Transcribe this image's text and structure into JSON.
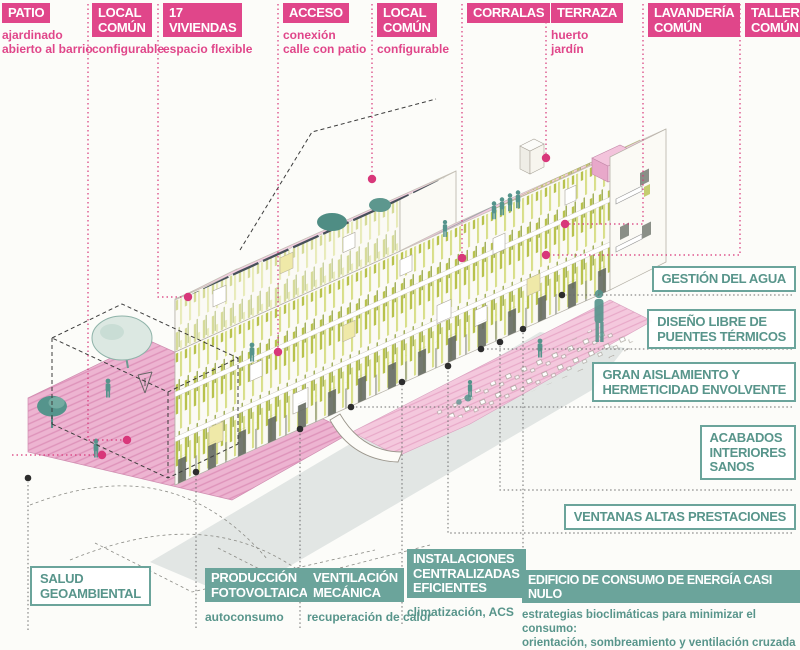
{
  "title": "Diagrama axonométrico de edificio de viviendas con estrategias sostenibles",
  "palette": {
    "paper": "#fcfcf9",
    "pink": "#e0468a",
    "pinkDot": "#d8377a",
    "teal": "#6ba49b",
    "tealText": "#58958b",
    "roof": "#f3cde0",
    "patioHatchBg": "#edb4d1",
    "patioHatchLine": "#de93ba",
    "veg1": "#b8c24d",
    "veg2": "#d6dc82",
    "veg3": "#8fa03c",
    "solar": "#47505a",
    "tree": "#55948c",
    "shadow": "#ccd4d3"
  },
  "top_labels": [
    {
      "id": "patio",
      "title": "PATIO",
      "subtitle": "ajardinado\nabierto al barrio"
    },
    {
      "id": "local-comun-1",
      "title": "LOCAL\nCOMÚN",
      "subtitle": "configurable"
    },
    {
      "id": "viviendas",
      "title": "17\nVIVIENDAS",
      "subtitle": "espacio flexible"
    },
    {
      "id": "acceso",
      "title": "ACCESO",
      "subtitle": "conexión\ncalle con patio"
    },
    {
      "id": "local-comun-2",
      "title": "LOCAL\nCOMÚN",
      "subtitle": "configurable"
    },
    {
      "id": "corralas",
      "title": "CORRALAS",
      "subtitle": ""
    },
    {
      "id": "terraza",
      "title": "TERRAZA",
      "subtitle": "huerto\njardín"
    },
    {
      "id": "lavanderia",
      "title": "LAVANDERÍA\nCOMÚN",
      "subtitle": ""
    },
    {
      "id": "taller",
      "title": "TALLER\nCOMÚN",
      "subtitle": ""
    }
  ],
  "right_labels": [
    "GESTIÓN DEL AGUA",
    "DISEÑO LIBRE DE\nPUENTES TÉRMICOS",
    "GRAN AISLAMIENTO Y\nHERMETICIDAD ENVOLVENTE",
    "ACABADOS\nINTERIORES\nSANOS",
    "VENTANAS ALTAS PRESTACIONES"
  ],
  "bottom_labels": [
    {
      "id": "salud",
      "style": "outline",
      "title": "SALUD\nGEOAMBIENTAL",
      "subtitle": ""
    },
    {
      "id": "produccion",
      "style": "solid",
      "title": "PRODUCCIÓN\nFOTOVOLTAICA",
      "subtitle": "autoconsumo"
    },
    {
      "id": "ventilacion",
      "style": "solid",
      "title": "VENTILACIÓN\nMECÁNICA",
      "subtitle": "recuperación de calor"
    },
    {
      "id": "instalaciones",
      "style": "solid",
      "title": "INSTALACIONES\nCENTRALIZADAS\nEFICIENTES",
      "subtitle": "climatización, ACS"
    },
    {
      "id": "edificio",
      "style": "solid",
      "title": "EDIFICIO DE CONSUMO DE ENERGÍA CASI NULO",
      "subtitle": "estrategias bioclimáticas para minimizar el consumo:\norientación, sombreamiento y ventilación cruzada"
    }
  ]
}
